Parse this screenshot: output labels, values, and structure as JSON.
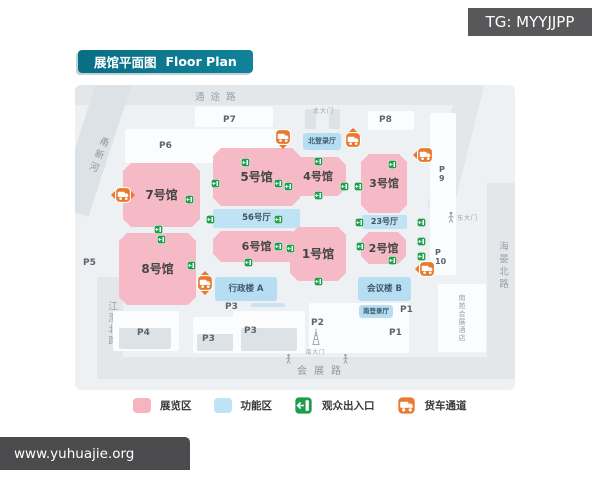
{
  "watermarks": {
    "top": "TG: MYYJJPP",
    "bottom": "www.yuhuajie.org"
  },
  "title": {
    "zh": "展馆平面图",
    "en": "Floor Plan"
  },
  "colors": {
    "title_teal": "#0c7f93",
    "exhibition_pink": "#f6bac6",
    "function_blue": "#bfe2f4",
    "entrance_green": "#1f9d4d",
    "truck_orange": "#e8792f",
    "road_gray": "#e3e7ea",
    "badge_gray": "#58585a"
  },
  "map": {
    "roads": {
      "top": "通途路",
      "bottom": "会展路",
      "right": "海晏北路",
      "left": "江澄北路",
      "river": "甬新河"
    },
    "blocks": [
      {
        "x": 50,
        "y": 44,
        "w": 162,
        "h": 34
      },
      {
        "x": 120,
        "y": 22,
        "w": 78,
        "h": 20
      },
      {
        "x": 293,
        "y": 26,
        "w": 46,
        "h": 19
      },
      {
        "x": 230,
        "y": 24,
        "w": 11,
        "h": 20,
        "shade": "gray"
      },
      {
        "x": 254,
        "y": 24,
        "w": 11,
        "h": 20,
        "shade": "gray"
      },
      {
        "x": 355,
        "y": 28,
        "w": 26,
        "h": 162
      },
      {
        "x": 38,
        "y": 226,
        "w": 66,
        "h": 40
      },
      {
        "x": 44,
        "y": 243,
        "w": 52,
        "h": 21,
        "shade": "gray"
      },
      {
        "x": 118,
        "y": 232,
        "w": 46,
        "h": 36
      },
      {
        "x": 122,
        "y": 249,
        "w": 38,
        "h": 17,
        "shade": "gray"
      },
      {
        "x": 158,
        "y": 226,
        "w": 72,
        "h": 42
      },
      {
        "x": 166,
        "y": 243,
        "w": 56,
        "h": 23,
        "shade": "gray"
      },
      {
        "x": 234,
        "y": 218,
        "w": 100,
        "h": 50
      },
      {
        "x": 176,
        "y": 218,
        "w": 34,
        "h": 4,
        "shade": "blue"
      }
    ],
    "halls": [
      {
        "id": "7",
        "label": "7号馆",
        "kind": "ex",
        "x": 48,
        "y": 78,
        "w": 77,
        "h": 64,
        "fs": 12
      },
      {
        "id": "8",
        "label": "8号馆",
        "kind": "ex",
        "x": 44,
        "y": 148,
        "w": 77,
        "h": 72,
        "fs": 12
      },
      {
        "id": "5",
        "label": "5号馆",
        "kind": "ex",
        "x": 138,
        "y": 63,
        "w": 87,
        "h": 58,
        "fs": 12
      },
      {
        "id": "56",
        "label": "56号厅",
        "kind": "strip",
        "x": 138,
        "y": 124,
        "w": 87,
        "h": 19,
        "fs": 8.5
      },
      {
        "id": "6",
        "label": "6号馆",
        "kind": "ex",
        "x": 138,
        "y": 146,
        "w": 87,
        "h": 31,
        "fs": 11
      },
      {
        "id": "4",
        "label": "4号馆",
        "kind": "ex",
        "x": 215,
        "y": 72,
        "w": 56,
        "h": 39,
        "fs": 11
      },
      {
        "id": "1",
        "label": "1号馆",
        "kind": "ex",
        "x": 215,
        "y": 142,
        "w": 56,
        "h": 54,
        "fs": 12
      },
      {
        "id": "3",
        "label": "3号馆",
        "kind": "ex",
        "x": 286,
        "y": 69,
        "w": 46,
        "h": 59,
        "fs": 11
      },
      {
        "id": "23",
        "label": "23号厅",
        "kind": "strip",
        "x": 287,
        "y": 130,
        "w": 45,
        "h": 14,
        "fs": 8
      },
      {
        "id": "2",
        "label": "2号馆",
        "kind": "ex",
        "x": 286,
        "y": 147,
        "w": 45,
        "h": 32,
        "fs": 11
      },
      {
        "id": "north-lobby",
        "label": "北登录厅",
        "kind": "fn",
        "x": 228,
        "y": 48,
        "w": 38,
        "h": 17,
        "fs": 7
      },
      {
        "id": "admin-a",
        "label": "行政楼 A",
        "kind": "fn",
        "x": 140,
        "y": 192,
        "w": 62,
        "h": 24,
        "fs": 8.5
      },
      {
        "id": "conference-b",
        "label": "会议楼 B",
        "kind": "fn",
        "x": 283,
        "y": 192,
        "w": 53,
        "h": 24,
        "fs": 8.5
      },
      {
        "id": "south-lobby",
        "label": "南登录厅",
        "kind": "fn",
        "x": 284,
        "y": 220,
        "w": 34,
        "h": 13,
        "fs": 6.5
      }
    ],
    "hotel": {
      "label": "南苑会展酒店",
      "x": 363,
      "y": 199,
      "w": 48,
      "h": 68
    },
    "parking": [
      {
        "label": "P7",
        "x": 148,
        "y": 30
      },
      {
        "label": "P6",
        "x": 84,
        "y": 56
      },
      {
        "label": "P8",
        "x": 304,
        "y": 30
      },
      {
        "label": "P\n9",
        "x": 364,
        "y": 80,
        "stacked": true
      },
      {
        "label": "P5",
        "x": 8,
        "y": 173
      },
      {
        "label": "P\n10",
        "x": 360,
        "y": 163,
        "stacked": true
      },
      {
        "label": "P4",
        "x": 62,
        "y": 243
      },
      {
        "label": "P3",
        "x": 150,
        "y": 217
      },
      {
        "label": "P3",
        "x": 127,
        "y": 249
      },
      {
        "label": "P3",
        "x": 169,
        "y": 241
      },
      {
        "label": "P2",
        "x": 236,
        "y": 233
      },
      {
        "label": "P1",
        "x": 325,
        "y": 220
      },
      {
        "label": "P1",
        "x": 314,
        "y": 243
      }
    ],
    "entrances": [
      [
        83,
        144
      ],
      [
        86,
        154
      ],
      [
        114,
        114
      ],
      [
        116,
        180
      ],
      [
        140,
        98
      ],
      [
        170,
        77
      ],
      [
        203,
        98
      ],
      [
        135,
        134
      ],
      [
        203,
        134
      ],
      [
        173,
        177
      ],
      [
        203,
        161
      ],
      [
        215,
        163
      ],
      [
        243,
        196
      ],
      [
        243,
        76
      ],
      [
        213,
        101
      ],
      [
        243,
        110
      ],
      [
        269,
        101
      ],
      [
        283,
        101
      ],
      [
        317,
        79
      ],
      [
        284,
        137
      ],
      [
        285,
        161
      ],
      [
        317,
        175
      ],
      [
        346,
        137
      ],
      [
        346,
        156
      ],
      [
        346,
        171
      ]
    ],
    "trucks": [
      {
        "x": 48,
        "y": 110,
        "arrows": "lr"
      },
      {
        "x": 208,
        "y": 52,
        "arrows": "d"
      },
      {
        "x": 278,
        "y": 55,
        "arrows": "u"
      },
      {
        "x": 350,
        "y": 70,
        "arrows": "l"
      },
      {
        "x": 130,
        "y": 198,
        "arrows": "ud"
      },
      {
        "x": 352,
        "y": 184,
        "arrows": "l"
      }
    ],
    "gates": [
      {
        "id": "north",
        "label": "北大门",
        "icon": "none",
        "x": 238,
        "y": 21
      },
      {
        "id": "east",
        "label": "东大门",
        "icon": "person",
        "x": 372,
        "y": 126
      },
      {
        "id": "south",
        "label": "南大门",
        "icon": "tower",
        "x": 231,
        "y": 243
      }
    ],
    "figures": [
      [
        210,
        268
      ],
      [
        267,
        268
      ]
    ]
  },
  "legend": {
    "items": [
      {
        "id": "exhibition",
        "label": "展览区",
        "swatch": "pink"
      },
      {
        "id": "function",
        "label": "功能区",
        "swatch": "blue"
      },
      {
        "id": "entrance",
        "label": "观众出入口",
        "icon": "entrance-icon"
      },
      {
        "id": "truck",
        "label": "货车通道",
        "icon": "truck-icon"
      }
    ]
  }
}
